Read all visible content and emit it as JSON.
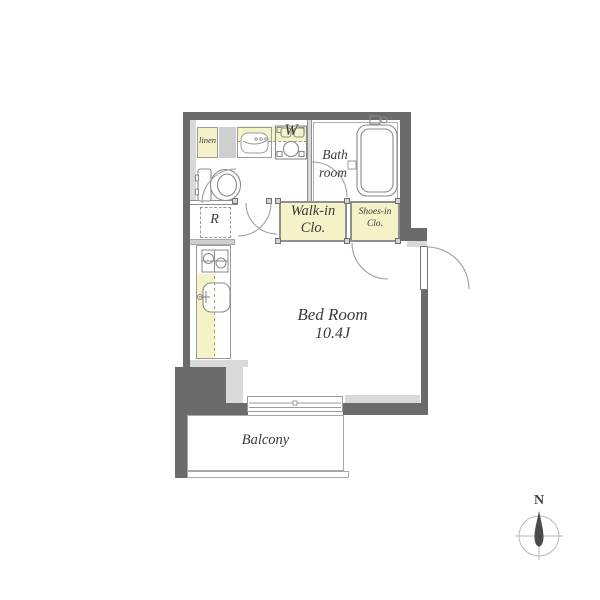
{
  "plan": {
    "labels": {
      "linen": "linen",
      "washer": "W",
      "bath_line1": "Bath",
      "bath_line2": "room",
      "refrigerator": "R",
      "walkin_line1": "Walk-in",
      "walkin_line2": "Clo.",
      "shoes_line1": "Shoes-in",
      "shoes_line2": "Clo.",
      "bedroom_name": "Bed Room",
      "bedroom_size": "10.4J",
      "balcony": "Balcony"
    },
    "compass": {
      "north": "N"
    },
    "colors": {
      "wall": "#6b6b6b",
      "wall_light": "#d9d9d9",
      "room_yellow": "#f6f2c8",
      "outline": "#9b9b9b",
      "text": "#3a3a3a",
      "background": "#ffffff"
    }
  }
}
